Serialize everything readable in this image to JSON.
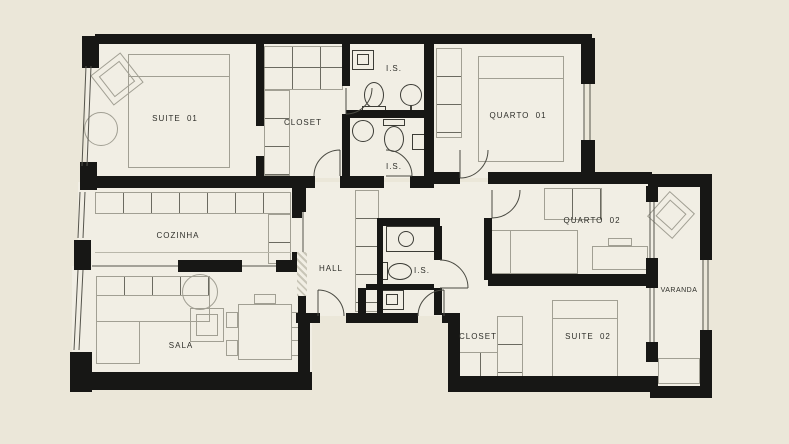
{
  "plan": {
    "type": "apartment-floor-plan",
    "colors": {
      "background": "#ebe7d9",
      "floor": "#f1eee4",
      "wall": "#171715",
      "furniture_line": "#a19f93",
      "fixture_line": "#3c3c36",
      "label_text": "#2e2e29"
    },
    "rooms": [
      {
        "id": "suite-01",
        "label": "SUITE 01"
      },
      {
        "id": "closet-01",
        "label": "CLOSET"
      },
      {
        "id": "is-01",
        "label": "I.S."
      },
      {
        "id": "quarto-01",
        "label": "QUARTO 01"
      },
      {
        "id": "is-02",
        "label": "I.S."
      },
      {
        "id": "cozinha",
        "label": "COZINHA"
      },
      {
        "id": "hall",
        "label": "HALL"
      },
      {
        "id": "is-03",
        "label": "I.S."
      },
      {
        "id": "quarto-02",
        "label": "QUARTO 02"
      },
      {
        "id": "sala",
        "label": "SALA"
      },
      {
        "id": "closet-02",
        "label": "CLOSET"
      },
      {
        "id": "suite-02",
        "label": "SUITE 02"
      },
      {
        "id": "varanda",
        "label": "VARANDA"
      }
    ]
  }
}
